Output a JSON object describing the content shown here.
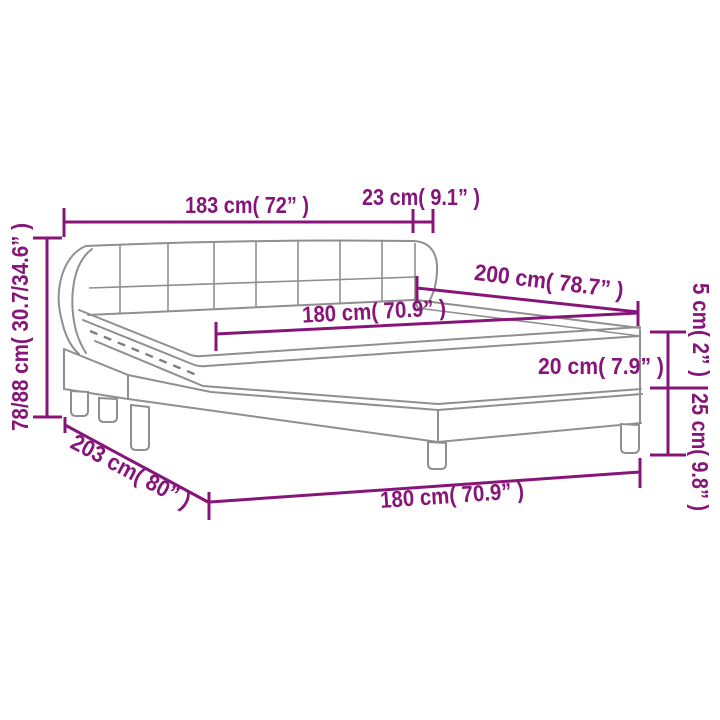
{
  "diagram_type": "product-dimension-diagram",
  "product": "box spring bed with tufted headboard, mattress and topper",
  "colors": {
    "dimension_accent": "#871579",
    "drawing_gray": "#8f8f8f",
    "background": "#ffffff"
  },
  "headboard": {
    "tufting_rows": 2,
    "tufting_columns": 8
  },
  "dims": {
    "headboard_width": {
      "label": "183 cm( 72” )"
    },
    "headboard_overhang": {
      "label": "23 cm( 9.1” )"
    },
    "bed_length": {
      "label": "200 cm( 78.7” )"
    },
    "mattress_width": {
      "label": "180 cm( 70.9” )"
    },
    "mattress_thickness": {
      "label": "20 cm( 7.9” )"
    },
    "topper_thickness": {
      "label": "5 cm( 2” )"
    },
    "base_height": {
      "label": "25 cm( 9.8” )"
    },
    "total_height": {
      "label": "78/88 cm( 30.7/34.6” )"
    },
    "frame_length": {
      "label": "203 cm( 80” )"
    },
    "frame_width": {
      "label": "180 cm( 70.9” )"
    }
  }
}
